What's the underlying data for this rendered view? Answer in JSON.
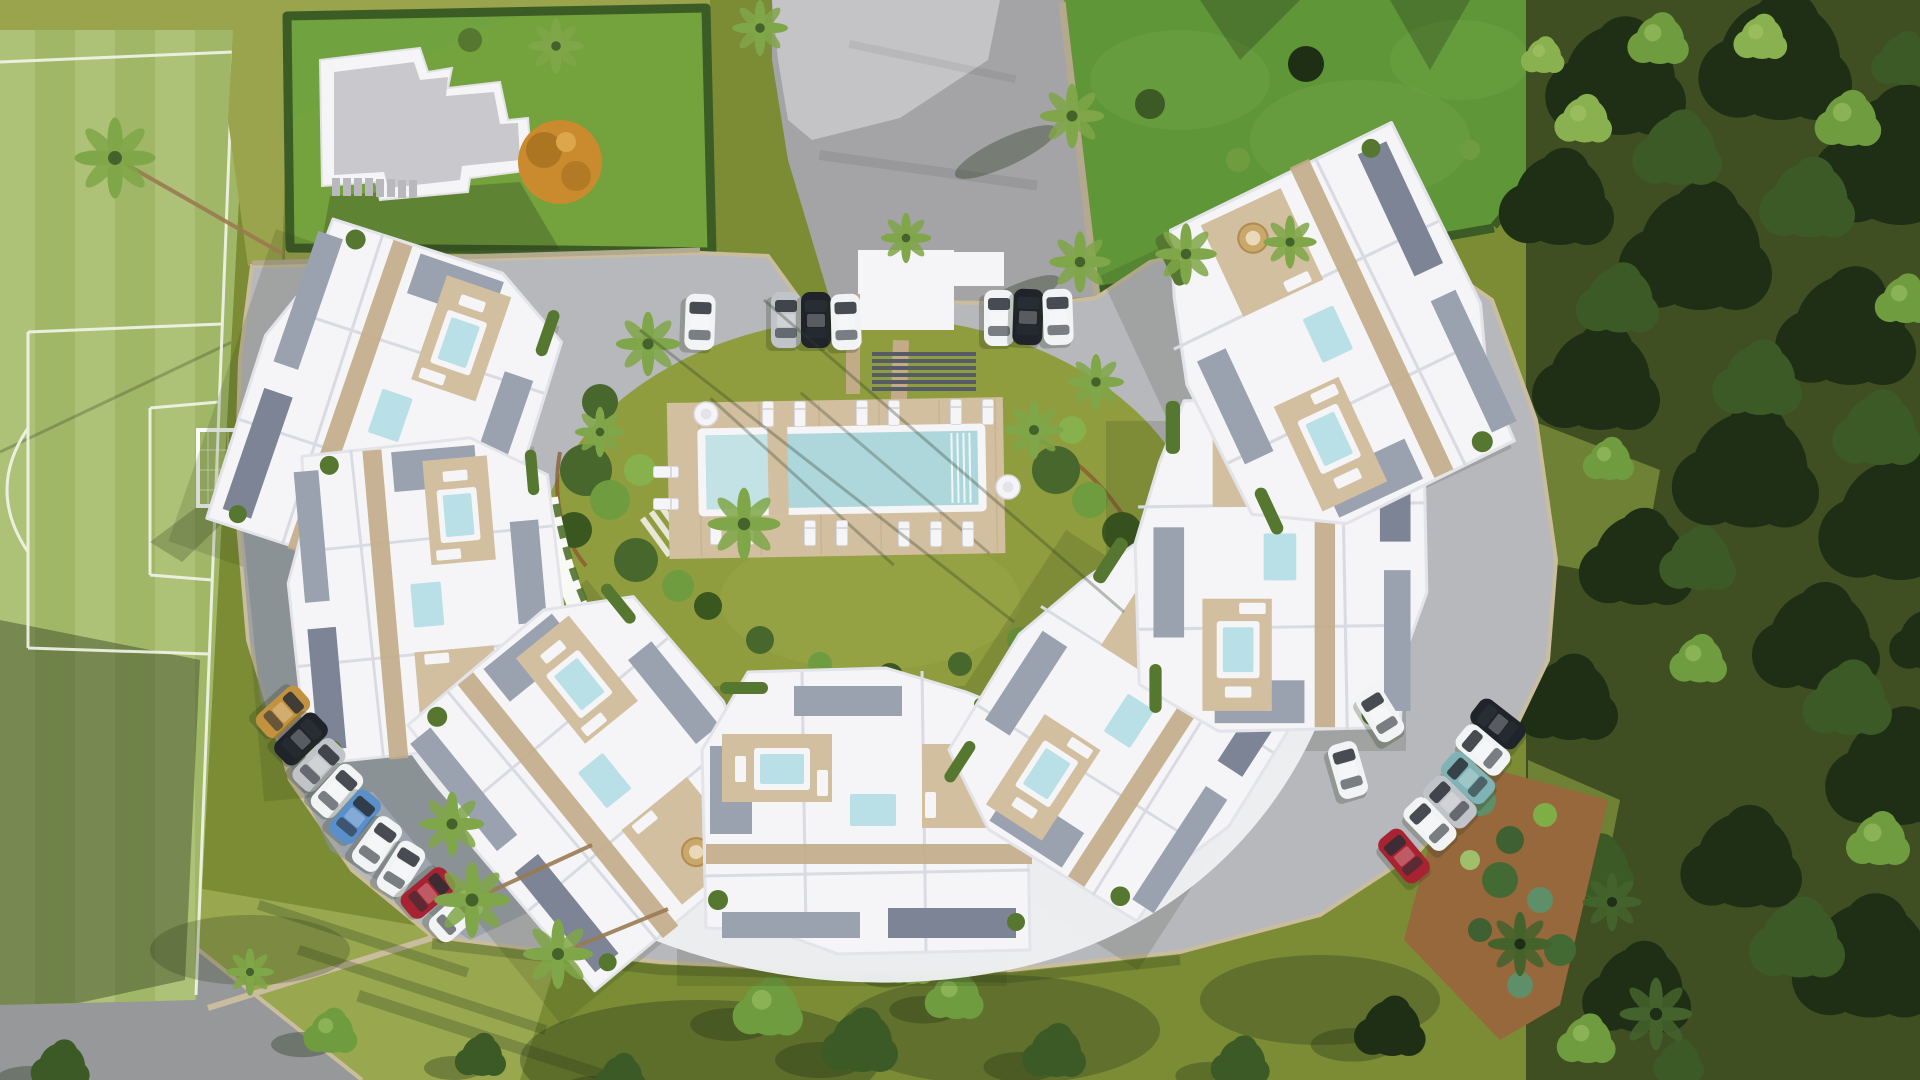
{
  "meta": {
    "subject": "aerial-render-residential-complex",
    "canvas": {
      "width": 1920,
      "height": 1080
    }
  },
  "palette": {
    "white": "#f5f5f7",
    "building_shade": "#d9dbe2",
    "gravel": "#9aa1af",
    "gravel_dark": "#7c8495",
    "deck": "#d2bf9f",
    "deck_dark": "#c2ac87",
    "plunge": "#b8e0e6",
    "pool_water": "#aed7dc",
    "pool_shallow": "#c2e2e5",
    "planter": "#55772f",
    "mulch": "#96683c",
    "soil": "#8a5d33",
    "asphalt": "#a4a4a6",
    "concrete": "#c6c6c8",
    "parking": "#b7b8bc",
    "parking_shadow": "#8b93a2",
    "courtyard_grass": "#8f9d3f",
    "field_light": "#adc276",
    "field_stripe": "#a1b768",
    "field_line": "#f2f5ea",
    "grass_olive": "#9aa44c",
    "villa_lawn": "#74a23d",
    "lawn_bright": "#5f9638",
    "lawn_patch": "#6ca342",
    "grass_bottom": "#7b8c35",
    "lawn_low": "#9cab52",
    "woods_floor": "#3f4f22",
    "road": "#96989a",
    "villa_roof": "#c9c9cd",
    "autumn": "#c98b2e",
    "autumn_dark": "#a56f1f",
    "hedge": "#3c5c26",
    "curb": "#c9bd9e",
    "wall": "#b3a98e",
    "trunk": "#9b7b52",
    "shadow_c": "#263318",
    "tree_dark": "#1f2f16",
    "tree_mid": "#3c5a26",
    "tree_light": "#6f9c3f",
    "tree_bright": "#8ab14f",
    "palm_green": "#7fa648",
    "palm_dark": "#44632c",
    "car_white": "#f2f3f5",
    "car_silver": "#c0c3c8",
    "car_black": "#20242a",
    "car_blue": "#5b8fc9",
    "car_red": "#a82331",
    "car_tan": "#c2923f",
    "car_teal": "#7fb3b5"
  },
  "scene": {
    "cars": [
      {
        "x": 700,
        "y": 322,
        "r": 2,
        "c": "white"
      },
      {
        "x": 786,
        "y": 320,
        "r": 0,
        "c": "silver"
      },
      {
        "x": 816,
        "y": 320,
        "r": 0,
        "c": "black"
      },
      {
        "x": 846,
        "y": 322,
        "r": -2,
        "c": "white"
      },
      {
        "x": 999,
        "y": 318,
        "r": 0,
        "c": "white"
      },
      {
        "x": 1028,
        "y": 317,
        "r": 2,
        "c": "black"
      },
      {
        "x": 1058,
        "y": 317,
        "r": -2,
        "c": "white"
      },
      {
        "x": 283,
        "y": 712,
        "r": 48,
        "c": "tan"
      },
      {
        "x": 301,
        "y": 739,
        "r": 46,
        "c": "black"
      },
      {
        "x": 319,
        "y": 765,
        "r": 44,
        "c": "silver"
      },
      {
        "x": 337,
        "y": 791,
        "r": 42,
        "c": "white"
      },
      {
        "x": 355,
        "y": 817,
        "r": 40,
        "c": "blue"
      },
      {
        "x": 377,
        "y": 844,
        "r": 36,
        "c": "white"
      },
      {
        "x": 401,
        "y": 869,
        "r": 32,
        "c": "white"
      },
      {
        "x": 428,
        "y": 893,
        "r": 50,
        "c": "red"
      },
      {
        "x": 456,
        "y": 916,
        "r": 48,
        "c": "white"
      },
      {
        "x": 1380,
        "y": 714,
        "r": -32,
        "c": "white"
      },
      {
        "x": 1348,
        "y": 770,
        "r": -16,
        "c": "white"
      },
      {
        "x": 1498,
        "y": 724,
        "r": -52,
        "c": "black"
      },
      {
        "x": 1483,
        "y": 750,
        "r": -50,
        "c": "white"
      },
      {
        "x": 1468,
        "y": 778,
        "r": -48,
        "c": "teal"
      },
      {
        "x": 1450,
        "y": 802,
        "r": -46,
        "c": "silver"
      },
      {
        "x": 1430,
        "y": 824,
        "r": -44,
        "c": "white"
      },
      {
        "x": 1404,
        "y": 856,
        "r": -40,
        "c": "red"
      }
    ],
    "palms": [
      {
        "x": 115,
        "y": 158,
        "s": 58,
        "tone": "light",
        "trunk": [
          168,
          96
        ]
      },
      {
        "x": 760,
        "y": 28,
        "s": 40,
        "tone": "light"
      },
      {
        "x": 556,
        "y": 46,
        "s": 40,
        "tone": "light"
      },
      {
        "x": 1072,
        "y": 116,
        "s": 46,
        "tone": "light"
      },
      {
        "x": 1080,
        "y": 262,
        "s": 44,
        "tone": "light"
      },
      {
        "x": 1186,
        "y": 254,
        "s": 44,
        "tone": "light"
      },
      {
        "x": 1290,
        "y": 242,
        "s": 38,
        "tone": "light"
      },
      {
        "x": 906,
        "y": 238,
        "s": 36,
        "tone": "light"
      },
      {
        "x": 648,
        "y": 344,
        "s": 46,
        "tone": "light"
      },
      {
        "x": 744,
        "y": 524,
        "s": 52,
        "tone": "light"
      },
      {
        "x": 1034,
        "y": 430,
        "s": 42,
        "tone": "light"
      },
      {
        "x": 1096,
        "y": 382,
        "s": 40,
        "tone": "light"
      },
      {
        "x": 600,
        "y": 432,
        "s": 36,
        "tone": "light"
      },
      {
        "x": 452,
        "y": 824,
        "s": 46,
        "tone": "light"
      },
      {
        "x": 472,
        "y": 900,
        "s": 54,
        "tone": "light",
        "trunk": [
          120,
          -55
        ]
      },
      {
        "x": 558,
        "y": 954,
        "s": 50,
        "tone": "light",
        "trunk": [
          110,
          -45
        ]
      },
      {
        "x": 1520,
        "y": 944,
        "s": 46,
        "tone": "dark"
      },
      {
        "x": 1612,
        "y": 902,
        "s": 42,
        "tone": "dark"
      },
      {
        "x": 1656,
        "y": 1014,
        "s": 52,
        "tone": "dark"
      },
      {
        "x": 250,
        "y": 972,
        "s": 34,
        "tone": "light"
      }
    ],
    "trees_right": [
      {
        "x": 1620,
        "y": 80,
        "s": 110,
        "tone": "dark"
      },
      {
        "x": 1780,
        "y": 60,
        "s": 120,
        "tone": "dark"
      },
      {
        "x": 1900,
        "y": 160,
        "s": 130,
        "tone": "dark"
      },
      {
        "x": 1700,
        "y": 250,
        "s": 120,
        "tone": "dark"
      },
      {
        "x": 1850,
        "y": 330,
        "s": 110,
        "tone": "dark"
      },
      {
        "x": 1600,
        "y": 380,
        "s": 100,
        "tone": "dark"
      },
      {
        "x": 1750,
        "y": 470,
        "s": 115,
        "tone": "dark"
      },
      {
        "x": 1900,
        "y": 520,
        "s": 120,
        "tone": "dark"
      },
      {
        "x": 1640,
        "y": 560,
        "s": 90,
        "tone": "dark"
      },
      {
        "x": 1820,
        "y": 640,
        "s": 100,
        "tone": "dark"
      },
      {
        "x": 1900,
        "y": 770,
        "s": 110,
        "tone": "dark"
      },
      {
        "x": 1745,
        "y": 860,
        "s": 95,
        "tone": "dark"
      },
      {
        "x": 1870,
        "y": 960,
        "s": 115,
        "tone": "dark"
      },
      {
        "x": 1640,
        "y": 990,
        "s": 85,
        "tone": "dark"
      },
      {
        "x": 1560,
        "y": 200,
        "s": 90,
        "tone": "dark"
      },
      {
        "x": 1570,
        "y": 700,
        "s": 80,
        "tone": "dark"
      },
      {
        "x": 1930,
        "y": 640,
        "s": 60,
        "tone": "dark"
      },
      {
        "x": 1680,
        "y": 150,
        "s": 70,
        "tone": "mid"
      },
      {
        "x": 1810,
        "y": 200,
        "s": 75,
        "tone": "mid"
      },
      {
        "x": 1620,
        "y": 300,
        "s": 65,
        "tone": "mid"
      },
      {
        "x": 1760,
        "y": 380,
        "s": 70,
        "tone": "mid"
      },
      {
        "x": 1880,
        "y": 430,
        "s": 70,
        "tone": "mid"
      },
      {
        "x": 1700,
        "y": 560,
        "s": 60,
        "tone": "mid"
      },
      {
        "x": 1850,
        "y": 700,
        "s": 70,
        "tone": "mid"
      },
      {
        "x": 1800,
        "y": 940,
        "s": 75,
        "tone": "mid"
      },
      {
        "x": 1598,
        "y": 868,
        "s": 60,
        "tone": "mid"
      },
      {
        "x": 1905,
        "y": 60,
        "s": 50,
        "tone": "mid"
      },
      {
        "x": 1680,
        "y": 1062,
        "s": 40,
        "tone": "mid"
      },
      {
        "x": 1585,
        "y": 120,
        "s": 45,
        "tone": "bright"
      },
      {
        "x": 1762,
        "y": 38,
        "s": 42,
        "tone": "bright"
      },
      {
        "x": 1544,
        "y": 56,
        "s": 34,
        "tone": "bright"
      },
      {
        "x": 1660,
        "y": 40,
        "s": 48,
        "tone": "light"
      },
      {
        "x": 1850,
        "y": 120,
        "s": 52,
        "tone": "light"
      },
      {
        "x": 1906,
        "y": 300,
        "s": 46,
        "tone": "light"
      },
      {
        "x": 1610,
        "y": 460,
        "s": 40,
        "tone": "light"
      },
      {
        "x": 1700,
        "y": 660,
        "s": 45,
        "tone": "light"
      },
      {
        "x": 1880,
        "y": 840,
        "s": 50,
        "tone": "light"
      },
      {
        "x": 1588,
        "y": 1040,
        "s": 46,
        "tone": "light"
      }
    ],
    "trees_bottom": [
      {
        "x": 770,
        "y": 1008,
        "s": 55,
        "tone": "light"
      },
      {
        "x": 862,
        "y": 1042,
        "s": 60,
        "tone": "mid"
      },
      {
        "x": 956,
        "y": 996,
        "s": 46,
        "tone": "light"
      },
      {
        "x": 1056,
        "y": 1052,
        "s": 50,
        "tone": "mid"
      },
      {
        "x": 482,
        "y": 1056,
        "s": 40,
        "tone": "mid"
      },
      {
        "x": 332,
        "y": 1032,
        "s": 42,
        "tone": "light"
      },
      {
        "x": 1392,
        "y": 1028,
        "s": 56,
        "tone": "dark"
      },
      {
        "x": 1242,
        "y": 1062,
        "s": 46,
        "tone": "mid"
      },
      {
        "x": 622,
        "y": 1076,
        "s": 40,
        "tone": "mid"
      },
      {
        "x": 62,
        "y": 1066,
        "s": 46,
        "tone": "mid"
      },
      {
        "x": 912,
        "y": 966,
        "s": 36,
        "tone": "bright"
      }
    ],
    "loungers": [
      {
        "x": 768,
        "y": 414,
        "r": 0
      },
      {
        "x": 800,
        "y": 414,
        "r": 0
      },
      {
        "x": 862,
        "y": 413,
        "r": 0
      },
      {
        "x": 894,
        "y": 413,
        "r": 0
      },
      {
        "x": 956,
        "y": 412,
        "r": 0
      },
      {
        "x": 988,
        "y": 412,
        "r": 0
      },
      {
        "x": 716,
        "y": 532,
        "r": 0
      },
      {
        "x": 748,
        "y": 532,
        "r": 0
      },
      {
        "x": 810,
        "y": 533,
        "r": 0
      },
      {
        "x": 842,
        "y": 533,
        "r": 0
      },
      {
        "x": 904,
        "y": 534,
        "r": 0
      },
      {
        "x": 936,
        "y": 534,
        "r": 0
      },
      {
        "x": 968,
        "y": 534,
        "r": 0
      },
      {
        "x": 666,
        "y": 472,
        "r": 90
      },
      {
        "x": 666,
        "y": 504,
        "r": 90
      }
    ],
    "parasols": [
      {
        "x": 706,
        "y": 414,
        "r": 12
      },
      {
        "x": 1008,
        "y": 487,
        "r": 12
      }
    ],
    "counts": {
      "building_clusters": 7,
      "detached_villa": 1,
      "main_pool": 1,
      "parked_cars": 25
    }
  }
}
